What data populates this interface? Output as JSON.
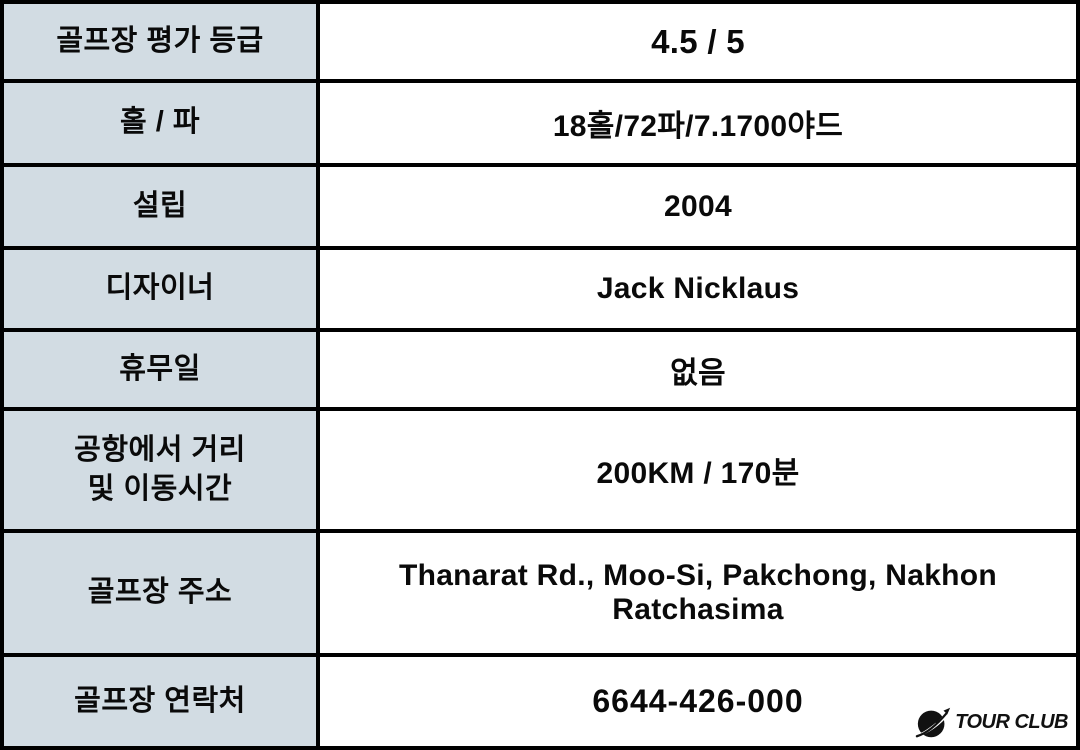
{
  "colors": {
    "label_bg": "#d2dce3",
    "value_bg": "#ffffff",
    "border": "#000000",
    "text": "#0a0a0a"
  },
  "table": {
    "rows": [
      {
        "label": "골프장 평가 등급",
        "value": "4.5 / 5"
      },
      {
        "label": "홀 / 파",
        "value": "18홀/72파/7.1700야드"
      },
      {
        "label": "설립",
        "value": "2004"
      },
      {
        "label": "디자이너",
        "value": "Jack Nicklaus"
      },
      {
        "label": "휴무일",
        "value": "없음"
      },
      {
        "label": "공항에서 거리",
        "label_line2": "및 이동시간",
        "value": "200KM / 170분"
      },
      {
        "label": "골프장 주소",
        "value": "Thanarat Rd., Moo-Si, Pakchong, Nakhon Ratchasima"
      },
      {
        "label": "골프장 연락처",
        "value": "6644-426-000"
      }
    ]
  },
  "logo": {
    "brand": "TOUR CLUB",
    "icon": "plane-swoosh-circle-icon"
  }
}
